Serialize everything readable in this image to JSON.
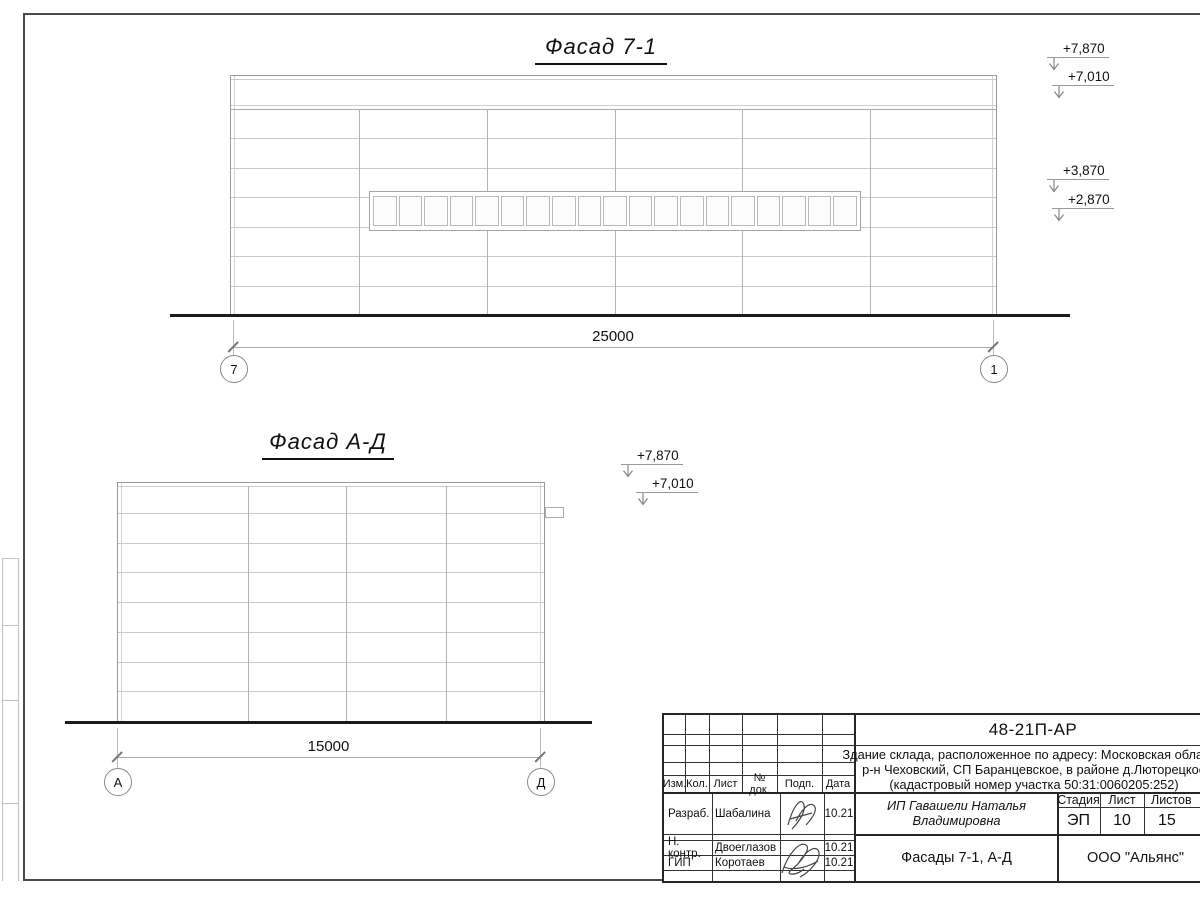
{
  "drawing": {
    "facade1": {
      "title": "Фасад 7-1",
      "dimension": "25000",
      "axes": [
        "7",
        "1"
      ],
      "levels": [
        "+7,870",
        "+7,010",
        "+3,870",
        "+2,870"
      ],
      "window_panes": 19
    },
    "facade2": {
      "title": "Фасад А-Д",
      "dimension": "15000",
      "axes": [
        "А",
        "Д"
      ],
      "levels": [
        "+7,870",
        "+7,010"
      ]
    }
  },
  "titleblock": {
    "doc_number": "48-21П-АР",
    "description_lines": [
      "Здание склада, расположенное по адресу: Московская область,",
      "р-н Чеховский, СП Баранцевское, в районе д.Люторецкое",
      "(кадастровый номер участка 50:31:0060205:252)"
    ],
    "header_cols": [
      "Изм.",
      "Кол.",
      "Лист",
      "№ док.",
      "Подп.",
      "Дата"
    ],
    "stage_cols": [
      "Стадия",
      "Лист",
      "Листов"
    ],
    "stage_values": [
      "ЭП",
      "10",
      "15"
    ],
    "client": "ИП Гавашели Наталья Владимировна",
    "sheet_title": "Фасады 7-1, А-Д",
    "company": "ООО \"Альянс\"",
    "signers": [
      {
        "role": "Разраб.",
        "name": "Шабалина",
        "date": "10.21"
      },
      {
        "role": "Н. контр.",
        "name": "Двоеглазов",
        "date": "10.21"
      },
      {
        "role": "ГИП",
        "name": "Коротаев",
        "date": "10.21"
      }
    ]
  }
}
